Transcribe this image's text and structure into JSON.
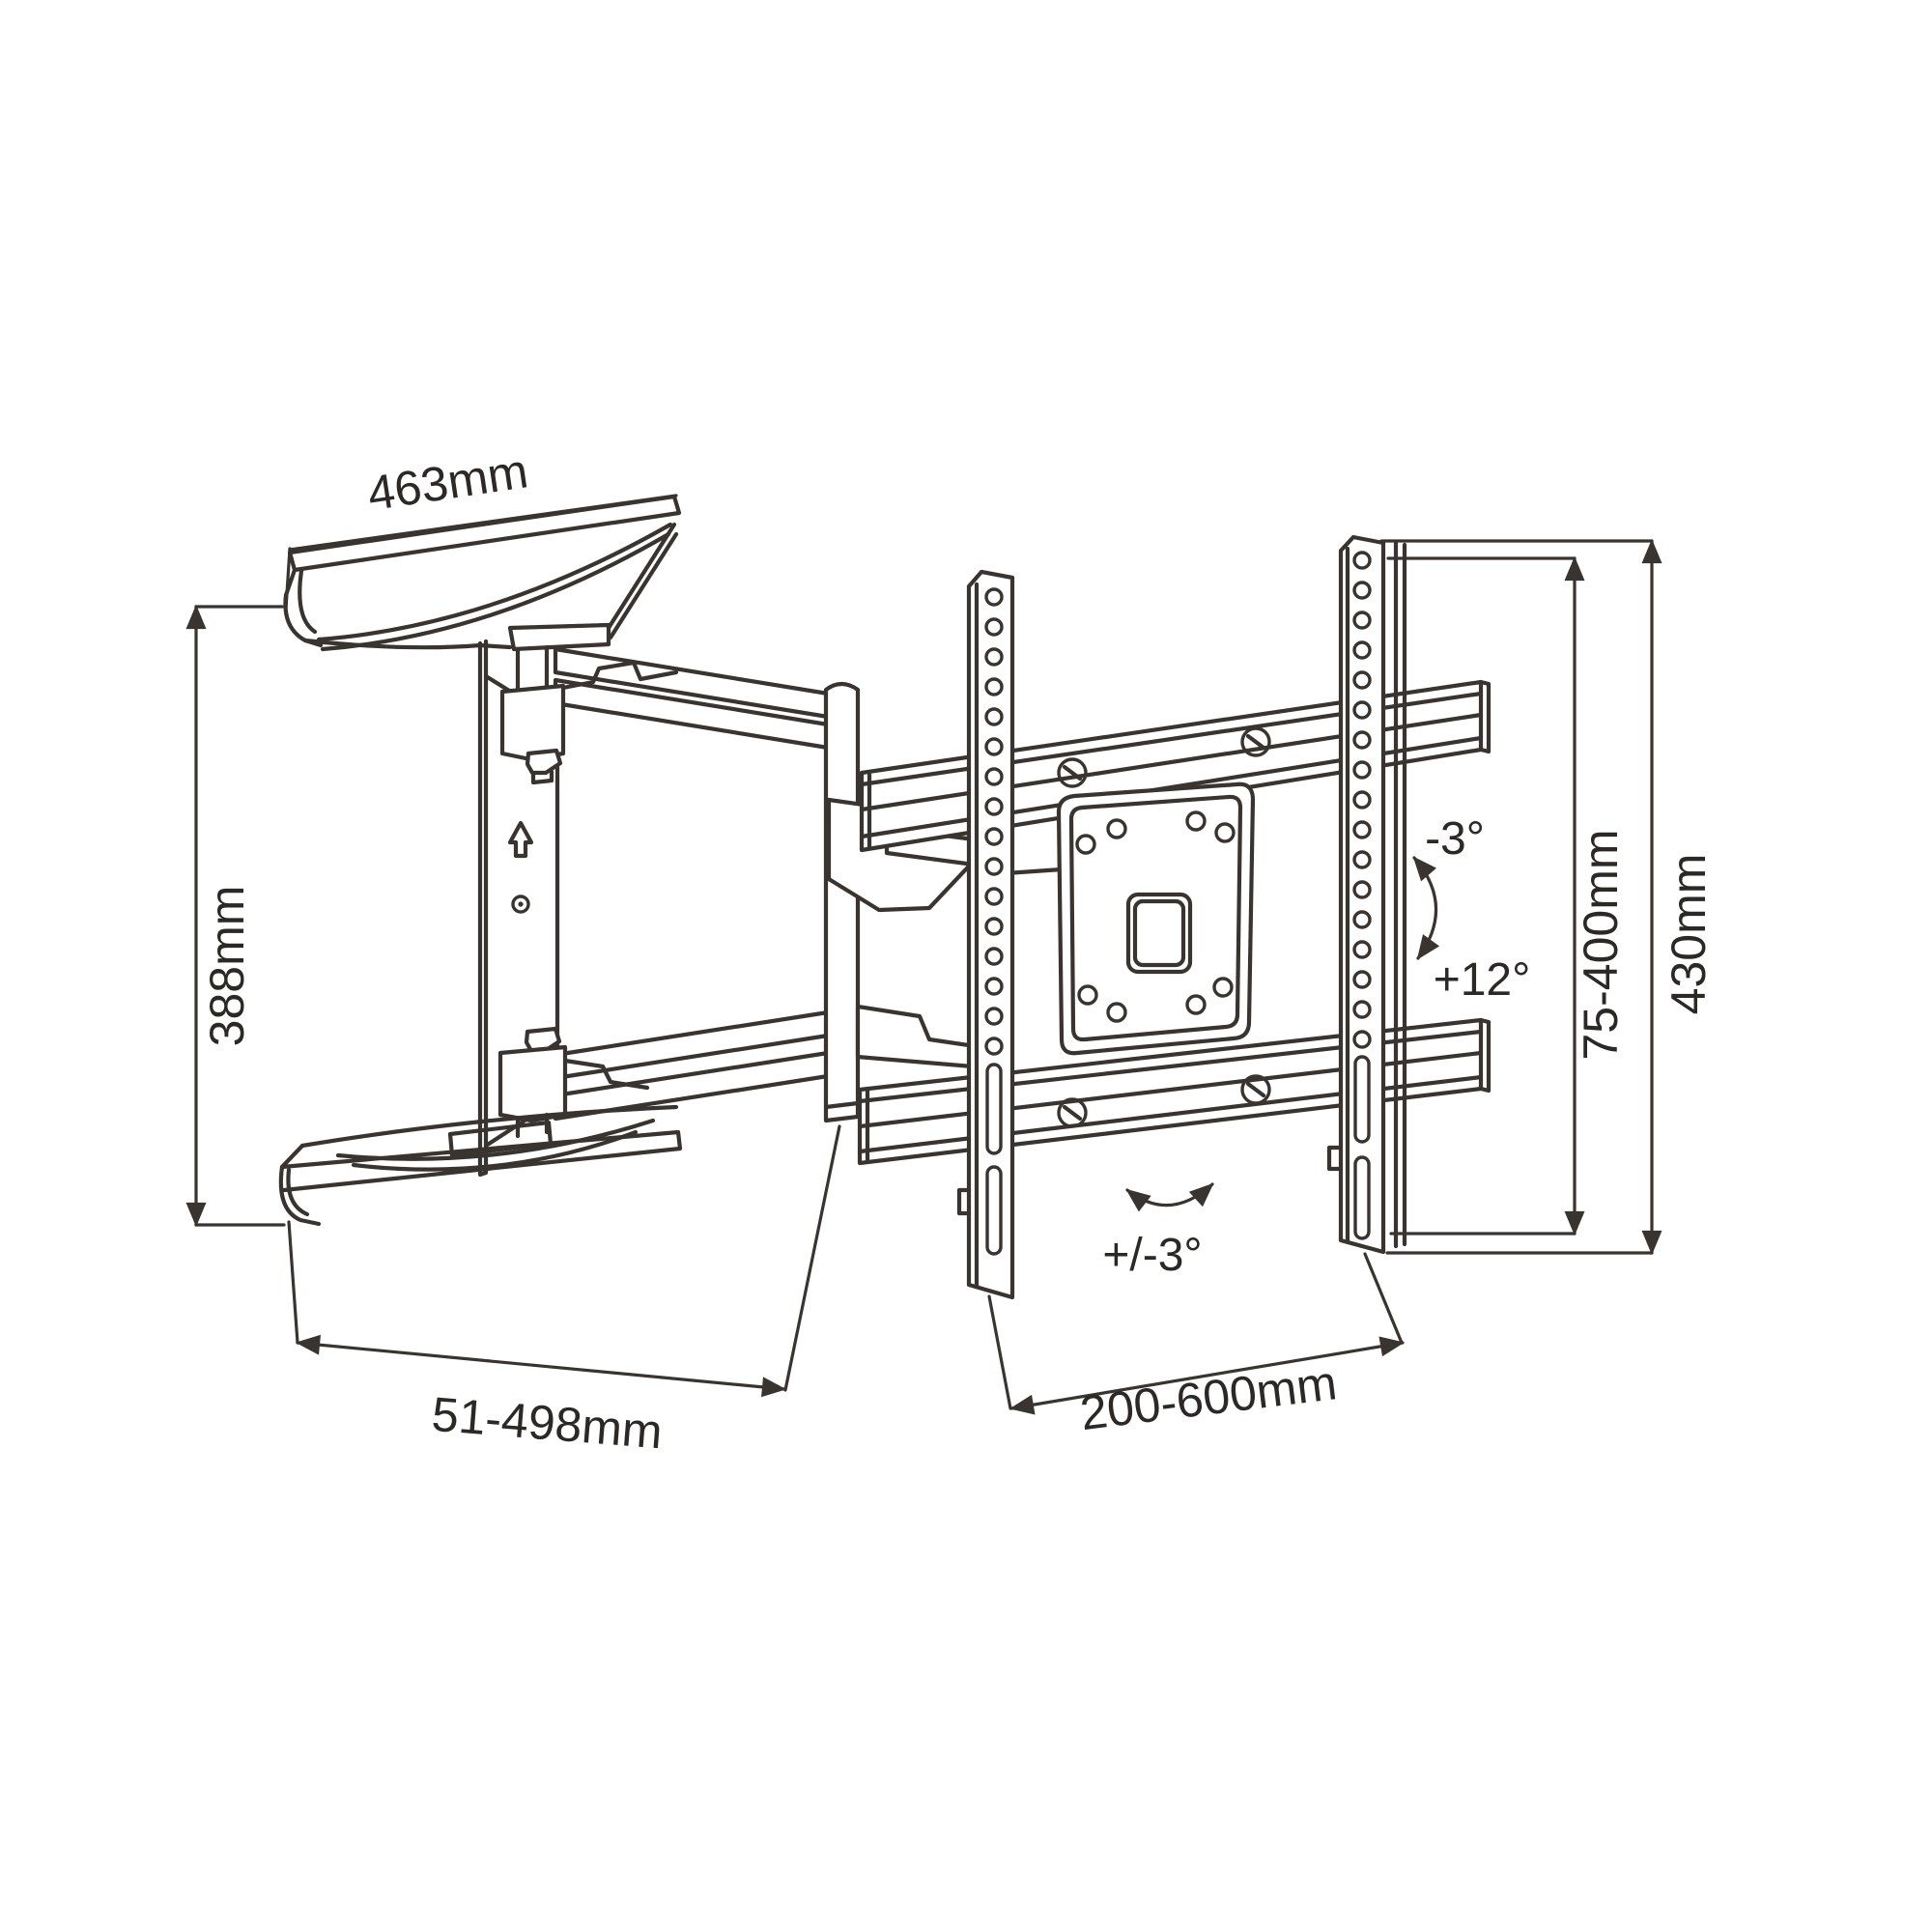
{
  "diagram": {
    "kind": "technical-line-drawing",
    "subject": "articulating-tv-wall-mount-dimension-diagram",
    "background_color": "#ffffff",
    "line_color": "#3a3430",
    "text_color": "#2c2826",
    "dimensions": {
      "top_plate_width": "463mm",
      "wall_plate_height": "388mm",
      "arm_extension": "51-498mm",
      "rail_width": "200-600mm",
      "vesa_height": "75-400mm",
      "bracket_height": "430mm"
    },
    "angles": {
      "swivel": "+/-3°",
      "tilt_back": "-3°",
      "tilt_forward": "+12°"
    },
    "icons": {
      "up_arrow": "up-arrow-icon",
      "swivel_arrows": "swivel-curved-arrow-icon",
      "tilt_arrows": "tilt-curved-arrow-icon"
    }
  }
}
